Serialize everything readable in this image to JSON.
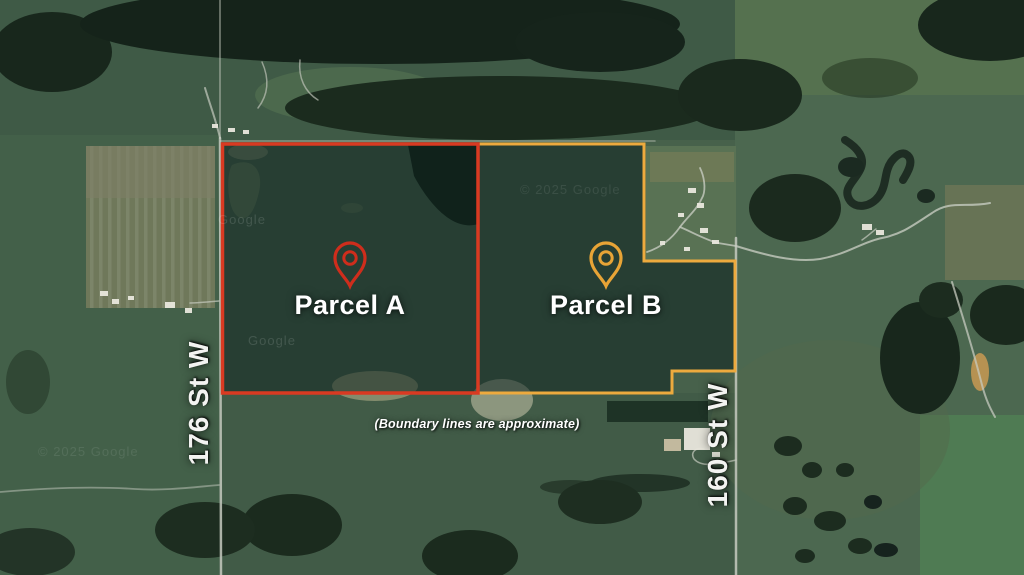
{
  "map": {
    "base_type": "satellite-imagery",
    "watermarks": [
      {
        "text": "Google"
      },
      {
        "text": "© 2025 Google"
      },
      {
        "text": "Google"
      },
      {
        "text": "© 2025 Google"
      }
    ]
  },
  "parcels": [
    {
      "name": "Parcel A",
      "boundary_color": "#d93a22",
      "pin_color": "#cf2d1c"
    },
    {
      "name": "Parcel B",
      "boundary_color": "#edaa3e",
      "pin_color": "#e8a436"
    }
  ],
  "roads": [
    {
      "name": "176 St W"
    },
    {
      "name": "160 St W"
    }
  ],
  "disclaimer": "(Boundary lines are approximate)",
  "colors": {
    "parcel_fill_overlay": "rgba(10,30,28,0.52)",
    "label_text": "#ffffff"
  }
}
